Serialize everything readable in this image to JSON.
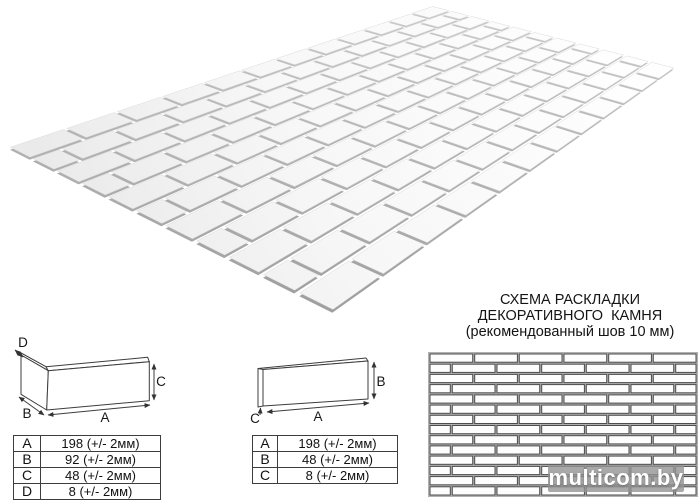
{
  "title_block": {
    "line1": "СХЕМА РАСКЛАДКИ",
    "line2": "ДЕКОРАТИВНОГО  КАМНЯ",
    "line3": "(рекомендованный шов 10 мм)"
  },
  "watermark": {
    "text": "multicom.by"
  },
  "corner_piece": {
    "labels": {
      "a": "A",
      "b": "B",
      "c": "C",
      "d": "D"
    },
    "table": {
      "rows": [
        {
          "dim": "A",
          "value": "198 (+/- 2мм)"
        },
        {
          "dim": "B",
          "value": "92 (+/- 2мм)"
        },
        {
          "dim": "C",
          "value": "48 (+/- 2мм)"
        },
        {
          "dim": "D",
          "value": "8 (+/- 2мм)"
        }
      ]
    }
  },
  "flat_piece": {
    "labels": {
      "a": "A",
      "b": "B",
      "c": "C"
    },
    "table": {
      "rows": [
        {
          "dim": "A",
          "value": "198 (+/- 2мм)"
        },
        {
          "dim": "B",
          "value": "48 (+/- 2мм)"
        },
        {
          "dim": "C",
          "value": "8 (+/- 2мм)"
        }
      ]
    }
  },
  "panel_3d": {
    "rows": 11,
    "cols": 12,
    "side_color_near": 156,
    "side_color_far": 200
  },
  "layout_pattern": {
    "rows": 14,
    "cols": 6,
    "background": "#b0b0b0",
    "brick_fill": "#fdfdfd",
    "brick_stroke": "#4d4d4d"
  }
}
